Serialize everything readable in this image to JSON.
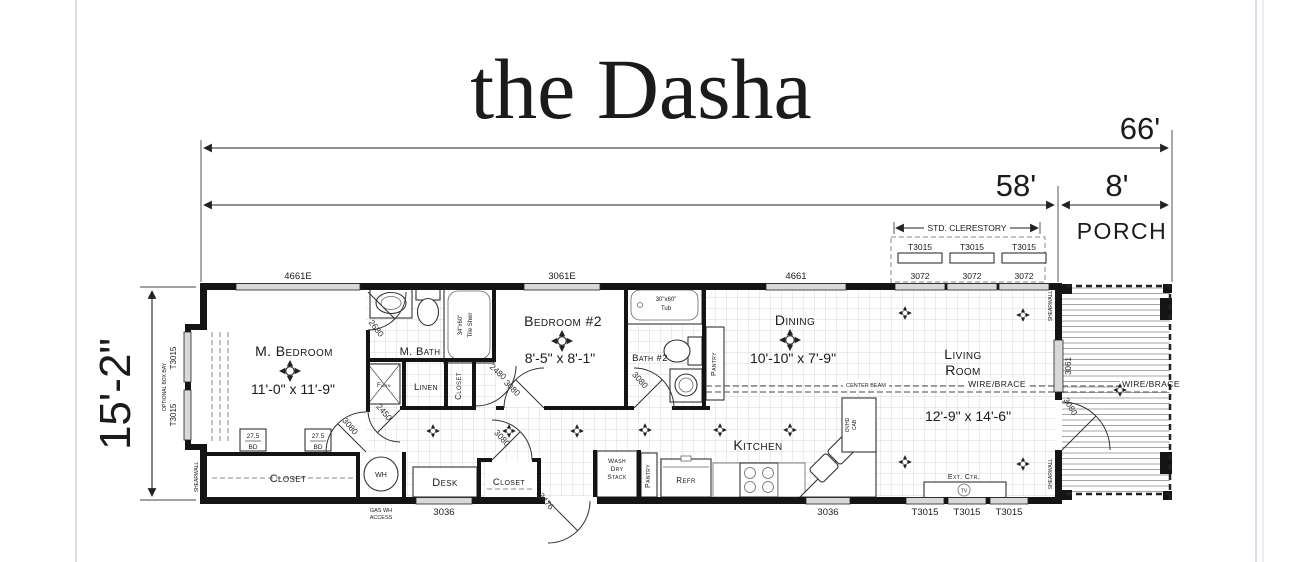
{
  "page": {
    "title": "the Dasha"
  },
  "colors": {
    "ink": "#1b1b1b",
    "wall": "#141414",
    "window_fill": "#d8d8d8"
  },
  "dims": {
    "overall": "66'",
    "body": "58'",
    "porch": "8'",
    "height": "15'-2\"",
    "clerestory": "STD. CLERESTORY"
  },
  "porch": {
    "label": "PORCH",
    "wire_brace": "WIRE/BRACE"
  },
  "windows": {
    "w4661e": "4661E",
    "w3061e": "3061E",
    "w4661": "4661",
    "w3061": "3061",
    "w3072": [
      "3072",
      "3072",
      "3072"
    ],
    "clerestory": [
      "T3015",
      "T3015",
      "T3015"
    ],
    "w3036_left": "3036",
    "w3036_right": "3036",
    "t3015_bottom": [
      "T3015",
      "T3015",
      "T3015"
    ],
    "bay": [
      "T3015",
      "T3015"
    ],
    "bay_note": "OPTIONAL BOX BAY"
  },
  "rooms": {
    "m_bedroom": {
      "name": "M. Bedroom",
      "size": "11'-0\" x 11'-9\""
    },
    "m_bath": {
      "name": "M. Bath"
    },
    "linen": {
      "name": "Linen"
    },
    "m_closet": {
      "name": "Closet"
    },
    "b2_closet": {
      "name": "Closet"
    },
    "bedroom2": {
      "name": "Bedroom #2",
      "size": "8'-5\" x 8'-1\""
    },
    "bath2": {
      "name": "Bath #2"
    },
    "dining": {
      "name": "Dining",
      "size": "10'-10\" x 7'-9\""
    },
    "kitchen": {
      "name": "Kitchen"
    },
    "living": {
      "line1": "Living",
      "line2": "Room",
      "size": "12'-9\" x 14'-6\""
    },
    "rear_closet": {
      "name": "Closet"
    },
    "desk": {
      "name": "Desk"
    }
  },
  "fixtures": {
    "shower_l1": "34\"x60\"",
    "shower_l2": "Tile Shwr",
    "tub_l1": "30\"x60\"",
    "tub_l2": "Tub",
    "furnace": "Furn",
    "water_heater": "WH",
    "wh_access_l1": "GAS WH",
    "wh_access_l2": "ACCESS",
    "washer_l1": "Wash",
    "washer_l2": "Dry",
    "washer_l3": "Stack",
    "pantry": "Pantry",
    "pantry2": "Pantry",
    "refrigerator": "Refr",
    "ovhd_l1": "OVHD",
    "ovhd_l2": "CAB",
    "ext_ctr": "Ext. Ctr.",
    "tv": "TV",
    "bed_board_size": "27.5",
    "bed_board": "BD"
  },
  "structure": {
    "center_beam": "CENTER BEAM",
    "wire_brace": "WIRE/BRACE",
    "shearwall": "SHEARWALL"
  },
  "doors": {
    "m_bath": "2680",
    "furnace": "2450",
    "m_bedroom": "3080",
    "hall": "3080",
    "bedroom2": "3080",
    "b2_closet": "2480",
    "bath2": "3080",
    "entry": "3476",
    "porch": "3080"
  },
  "icons": {
    "ceiling_fan": "four-point-fan-symbol",
    "ceiling_light": "four-point-light-symbol",
    "tv_jack": "circled TV"
  }
}
